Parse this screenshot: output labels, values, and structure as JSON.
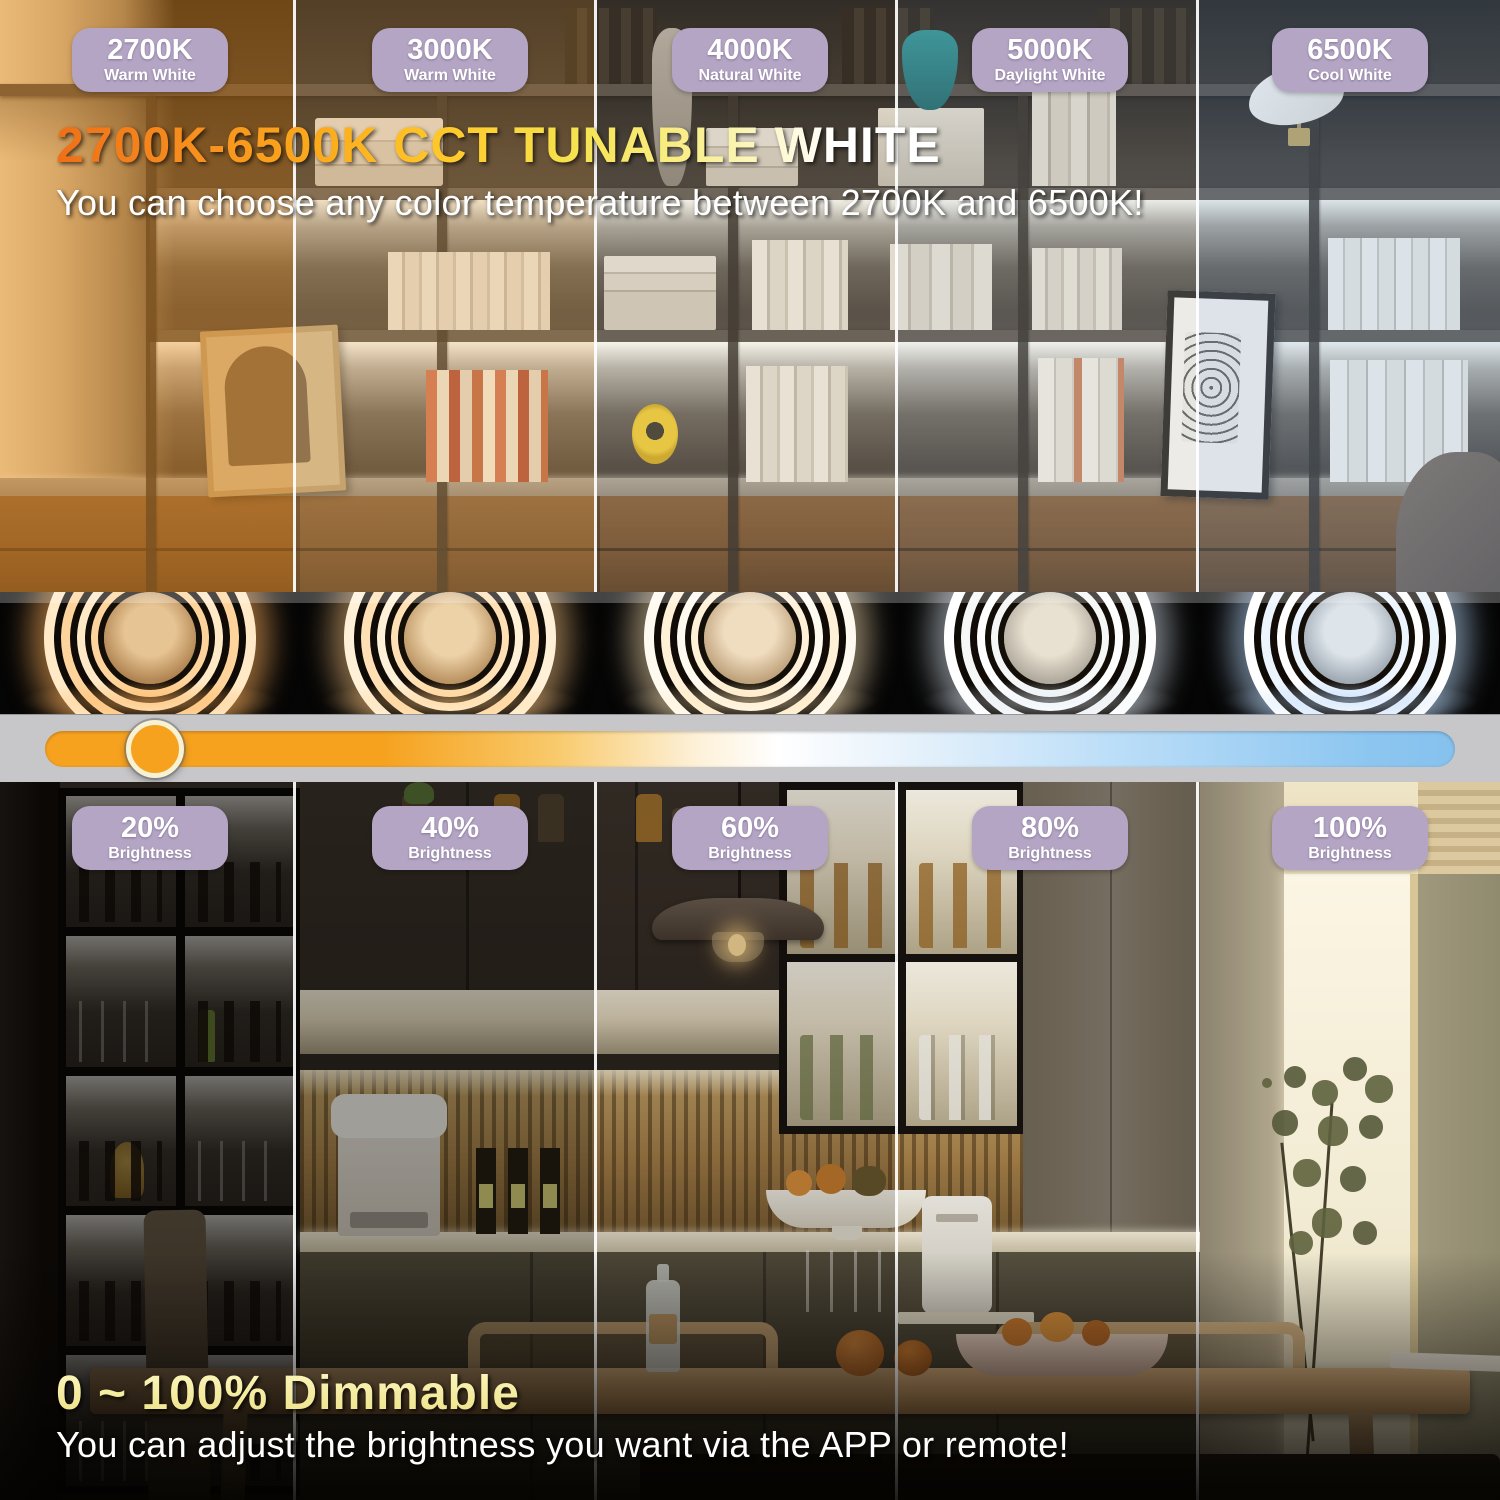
{
  "cct_section": {
    "title": "2700K-6500K CCT TUNABLE WHITE",
    "subtitle": "You can choose any color temperature between 2700K and 6500K!",
    "badges": [
      {
        "value": "2700K",
        "label": "Warm White"
      },
      {
        "value": "3000K",
        "label": "Warm White"
      },
      {
        "value": "4000K",
        "label": "Natural White"
      },
      {
        "value": "5000K",
        "label": "Daylight White"
      },
      {
        "value": "6500K",
        "label": "Cool White"
      }
    ]
  },
  "temperature_slider": {
    "knob_position_percent": 8,
    "warm_end_color": "#f6a21f",
    "cool_end_color": "#8cc6f0",
    "band_color": "#c7c6c8",
    "knob_color": "#f6a21f"
  },
  "dim_section": {
    "title": "0 ~ 100% Dimmable",
    "subtitle": "You can adjust the brightness you want via the APP or remote!",
    "badges": [
      {
        "value": "20%",
        "label": "Brightness"
      },
      {
        "value": "40%",
        "label": "Brightness"
      },
      {
        "value": "60%",
        "label": "Brightness"
      },
      {
        "value": "80%",
        "label": "Brightness"
      },
      {
        "value": "100%",
        "label": "Brightness"
      }
    ]
  },
  "colors": {
    "badge_background": "#b3a5c3",
    "badge_text": "#ffffff",
    "title_gradient_start": "#ef6f17",
    "title_gradient_mid": "#ffc929",
    "title_gradient_end": "#ffffff",
    "dim_title_color": "#f5eea0"
  }
}
